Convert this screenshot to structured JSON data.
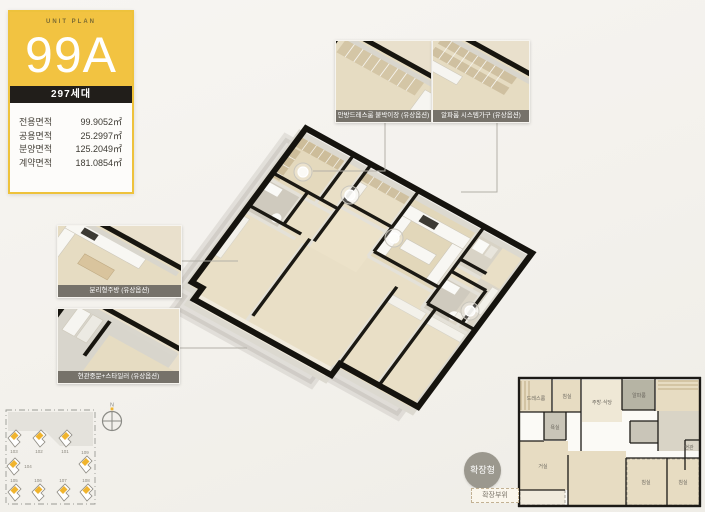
{
  "unit_card": {
    "header_label": "UNIT PLAN",
    "unit_name": "99A",
    "households_badge": "297세대",
    "areas": [
      {
        "label": "전용면적",
        "value": "99.9052㎡"
      },
      {
        "label": "공용면적",
        "value": "25.2997㎡"
      },
      {
        "label": "분양면적",
        "value": "125.2049㎡"
      },
      {
        "label": "계약면적",
        "value": "181.0854㎡"
      }
    ]
  },
  "callouts": {
    "top": [
      {
        "label": "안방드레스룸 붙박이장 (유상옵션)"
      },
      {
        "label": "알파룸 시스템가구 (유상옵션)"
      }
    ],
    "left": [
      {
        "label": "분리형주방 (유상옵션)"
      },
      {
        "label": "현관중문+스타일러 (유상옵션)"
      }
    ]
  },
  "site_plan": {
    "compass_label": "N",
    "building_numbers": [
      "103",
      "102",
      "101",
      "104",
      "109",
      "105",
      "106",
      "107",
      "108"
    ]
  },
  "expansion": {
    "badge": "확장형",
    "legend": "확장부위"
  },
  "mini_plan": {
    "room_labels": [
      "드레스룸",
      "침실",
      "주방·식당",
      "알파룸",
      "욕실",
      "거실",
      "침실",
      "침실",
      "현관"
    ]
  },
  "colors": {
    "accent_yellow": "#f2c341",
    "badge_black": "#211e1a",
    "wall_black": "#1b1813",
    "floor_beige": "#e9dfc6",
    "wet_gray": "#cfcabe",
    "badge_gray": "#9b988e"
  }
}
